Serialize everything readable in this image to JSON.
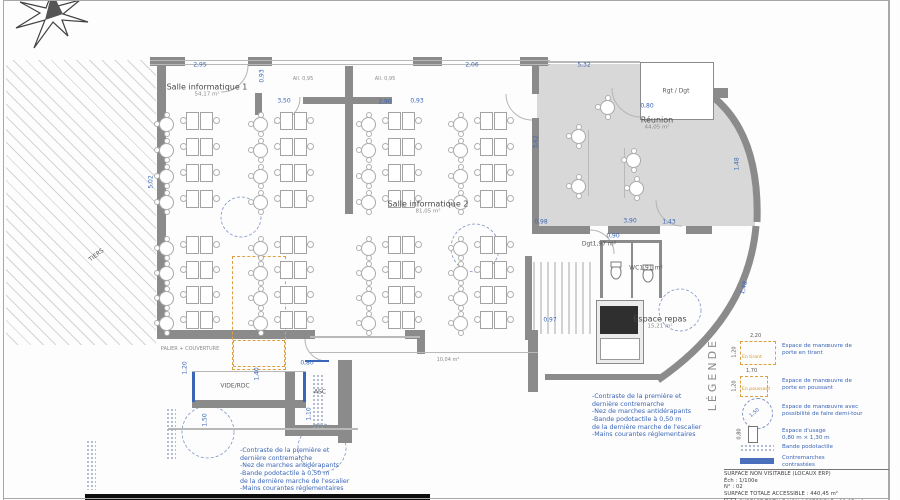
{
  "doc": {
    "kind": "architectural accessibility floor plan"
  },
  "colors": {
    "blue": "#3a66b8",
    "orange": "#dd9f3f",
    "wall": "#8b8b8b",
    "room_fill": "#d8d8d8"
  },
  "rooms": [
    {
      "name": "Salle informatique 1",
      "area": "54,17 m²",
      "x": 207,
      "y": 90,
      "big": true
    },
    {
      "name": "Salle informatique 2",
      "area": "81,05 m²",
      "x": 428,
      "y": 207,
      "big": true
    },
    {
      "name": "Réunion",
      "area": "44,05 m²",
      "x": 657,
      "y": 123,
      "big": true
    },
    {
      "name": "Rgt / Dgt",
      "area": "",
      "x": 676,
      "y": 92,
      "big": false
    },
    {
      "name": "Espace repas",
      "area": "15,21 m²",
      "x": 660,
      "y": 322,
      "big": true
    },
    {
      "name": "Dgt",
      "area": "1,97 m²",
      "x": 599,
      "y": 245,
      "big": false
    },
    {
      "name": "WC",
      "area": "1,91 m²",
      "x": 646,
      "y": 269,
      "big": false
    },
    {
      "name": "ASC",
      "area": "",
      "x": 320,
      "y": 393,
      "big": false
    },
    {
      "name": "VIDE/RDC",
      "area": "",
      "x": 235,
      "y": 387,
      "big": false
    },
    {
      "name": "TIERS",
      "area": "",
      "x": 97,
      "y": 256,
      "big": false,
      "rot": -38
    }
  ],
  "small_labels": [
    {
      "t": "All. 0,95",
      "x": 303,
      "y": 80
    },
    {
      "t": "All. 0,95",
      "x": 385,
      "y": 80
    },
    {
      "t": "10,04 m²",
      "x": 448,
      "y": 361
    },
    {
      "t": "PALIER + COUVERTURE",
      "x": 190,
      "y": 350
    }
  ],
  "dims": [
    {
      "t": "2,95",
      "x": 200,
      "y": 66
    },
    {
      "t": "0,93",
      "x": 263,
      "y": 76,
      "r": 90
    },
    {
      "t": "3,50",
      "x": 284,
      "y": 102
    },
    {
      "t": "2,90",
      "x": 385,
      "y": 103
    },
    {
      "t": "0,93",
      "x": 417,
      "y": 102
    },
    {
      "t": "5,02",
      "x": 152,
      "y": 182,
      "r": 90
    },
    {
      "t": "5,32",
      "x": 584,
      "y": 66
    },
    {
      "t": "0,80",
      "x": 647,
      "y": 107
    },
    {
      "t": "3,62",
      "x": 537,
      "y": 142,
      "r": 90
    },
    {
      "t": "1,48",
      "x": 738,
      "y": 164,
      "r": 90
    },
    {
      "t": "0,98",
      "x": 541,
      "y": 223
    },
    {
      "t": "3,90",
      "x": 630,
      "y": 222
    },
    {
      "t": "1,43",
      "x": 669,
      "y": 223
    },
    {
      "t": "0,80",
      "x": 307,
      "y": 364
    },
    {
      "t": "1,10",
      "x": 310,
      "y": 414,
      "r": 90
    },
    {
      "t": "1,50",
      "x": 206,
      "y": 420,
      "r": 90
    },
    {
      "t": "0,97",
      "x": 550,
      "y": 321
    },
    {
      "t": "1,40",
      "x": 258,
      "y": 374,
      "r": 90
    },
    {
      "t": "1,20",
      "x": 186,
      "y": 368,
      "r": 90
    },
    {
      "t": "0,90",
      "x": 613,
      "y": 237
    },
    {
      "t": "1,48",
      "x": 745,
      "y": 288,
      "r": 75
    },
    {
      "t": "2,06",
      "x": 472,
      "y": 66
    }
  ],
  "notes": {
    "lines": [
      "-Contraste de la première et",
      "dernière contremarche",
      "-Nez de marches antidérapants",
      "-Bande podotactile à 0,50 m",
      "de la dernière marche de l'escalier",
      "-Mains courantes réglementaires"
    ],
    "positions": [
      {
        "x": 240,
        "y": 447
      },
      {
        "x": 592,
        "y": 393
      }
    ]
  },
  "legend": {
    "title": "LÉGENDE",
    "items": [
      {
        "swatch": "rect-orange",
        "w": 34,
        "h": 22,
        "dim_top": "2,20",
        "dim_left": "1,20",
        "tag": "En tirant",
        "desc": [
          "Espace de manœuvre de",
          "porte en tirant"
        ],
        "y": 333
      },
      {
        "swatch": "rect-orange",
        "w": 26,
        "h": 19,
        "dim_top": "1,70",
        "dim_left": "1,20",
        "tag": "En poussant",
        "desc": [
          "Espace de manœuvre de",
          "porte en poussant"
        ],
        "y": 368
      },
      {
        "swatch": "circle-blue",
        "d": 29,
        "dim_diag": "1,50",
        "desc": [
          "Espace de manœuvre avec",
          "possibilité de faire demi-tour"
        ],
        "y": 396
      },
      {
        "swatch": "usage",
        "dim_left": "0,80",
        "desc": [
          "Espace d'usage",
          "0,80 m × 1,30 m"
        ],
        "y": 426
      },
      {
        "swatch": "dots",
        "desc": [
          "Bande podotactile"
        ],
        "y": 443
      },
      {
        "swatch": "bar-blue",
        "desc": [
          "Contremarches",
          "contrastées"
        ],
        "y": 455
      }
    ]
  },
  "title_block": {
    "rows": [
      "SURFACE NON VISITABLE (LOCAUX ERP)",
      "Éch : 1/100e",
      "N° : 02",
      "SURFACE TOTALE ACCESSIBLE : 440,45 m²"
    ],
    "hatch_row": "SURFACE TOTALE NON ACCESSIBLE : 98,05 m²"
  },
  "geometry": {
    "walls": [
      [
        150,
        57,
        35,
        9
      ],
      [
        248,
        57,
        24,
        9
      ],
      [
        413,
        57,
        29,
        9
      ],
      [
        520,
        57,
        28,
        9
      ],
      [
        157,
        62,
        9,
        276
      ],
      [
        157,
        330,
        158,
        9
      ],
      [
        405,
        330,
        20,
        9
      ],
      [
        417,
        330,
        8,
        24
      ],
      [
        345,
        66,
        8,
        148
      ],
      [
        303,
        97,
        89,
        7
      ],
      [
        255,
        93,
        7,
        22
      ],
      [
        532,
        62,
        7,
        32
      ],
      [
        532,
        118,
        7,
        110
      ],
      [
        532,
        226,
        58,
        8
      ],
      [
        608,
        226,
        52,
        8
      ],
      [
        686,
        226,
        26,
        8
      ],
      [
        712,
        88,
        16,
        10
      ],
      [
        600,
        240,
        62,
        3
      ],
      [
        600,
        240,
        3,
        58
      ],
      [
        659,
        240,
        3,
        58
      ],
      [
        631,
        242,
        2,
        56
      ],
      [
        525,
        256,
        7,
        84
      ],
      [
        528,
        330,
        10,
        62
      ],
      [
        545,
        374,
        116,
        6
      ],
      [
        285,
        372,
        10,
        64
      ],
      [
        338,
        360,
        14,
        83
      ],
      [
        285,
        425,
        67,
        11
      ],
      [
        192,
        400,
        114,
        8
      ]
    ],
    "thin_lines": [
      [
        150,
        60,
        400,
        1
      ],
      [
        150,
        64,
        400,
        1
      ],
      [
        548,
        61,
        92,
        2
      ],
      [
        310,
        336,
        110,
        2
      ],
      [
        310,
        352,
        228,
        1
      ],
      [
        192,
        371,
        114,
        1
      ],
      [
        168,
        428,
        190,
        2
      ],
      [
        588,
        130,
        1,
        66
      ],
      [
        624,
        148,
        1,
        50
      ],
      [
        596,
        300,
        46,
        1
      ],
      [
        596,
        300,
        1,
        62
      ],
      [
        641,
        300,
        1,
        62
      ],
      [
        596,
        361,
        46,
        1
      ]
    ],
    "blue_rails": [
      [
        192,
        372,
        3,
        30
      ],
      [
        303,
        372,
        3,
        30
      ],
      [
        305,
        360,
        24,
        2
      ]
    ],
    "orange_rects": [
      [
        232,
        256,
        52,
        112
      ],
      [
        233,
        340,
        50,
        25
      ]
    ],
    "turning_circles": [
      [
        241,
        217,
        20
      ],
      [
        475,
        248,
        24
      ],
      [
        680,
        310,
        21
      ],
      [
        208,
        432,
        26
      ],
      [
        322,
        448,
        24
      ]
    ],
    "dot_strips": [
      [
        312,
        374,
        12,
        54
      ],
      [
        166,
        408,
        10,
        52
      ],
      [
        86,
        440,
        10,
        50
      ]
    ],
    "hatch_areas": [
      [
        6,
        60,
        150,
        285
      ]
    ],
    "dark_bars": [
      [
        85,
        494,
        345,
        6
      ]
    ],
    "frame": [
      [
        3,
        0,
        1,
        500
      ],
      [
        888,
        0,
        2,
        500
      ],
      [
        3,
        498,
        887,
        1
      ],
      [
        3,
        0,
        887,
        1
      ]
    ],
    "appliances": {
      "counter": [
        596,
        300,
        46,
        62
      ],
      "range": [
        600,
        306,
        38,
        28
      ],
      "sink": [
        600,
        338,
        38,
        20
      ]
    }
  },
  "furniture": {
    "desk_cols": [
      {
        "x": 186,
        "y": 112,
        "rows": 4,
        "step": 26
      },
      {
        "x": 280,
        "y": 112,
        "rows": 4,
        "step": 26
      },
      {
        "x": 388,
        "y": 112,
        "rows": 4,
        "step": 26
      },
      {
        "x": 480,
        "y": 112,
        "rows": 4,
        "step": 26
      },
      {
        "x": 186,
        "y": 236,
        "rows": 4,
        "step": 25
      },
      {
        "x": 280,
        "y": 236,
        "rows": 4,
        "step": 25
      },
      {
        "x": 388,
        "y": 236,
        "rows": 4,
        "step": 25
      },
      {
        "x": 480,
        "y": 236,
        "rows": 4,
        "step": 25
      }
    ],
    "table_cols": [
      {
        "x": 158,
        "y": 116,
        "rows": 4,
        "step": 26
      },
      {
        "x": 252,
        "y": 116,
        "rows": 4,
        "step": 26
      },
      {
        "x": 360,
        "y": 116,
        "rows": 4,
        "step": 26
      },
      {
        "x": 452,
        "y": 116,
        "rows": 4,
        "step": 26
      },
      {
        "x": 158,
        "y": 240,
        "rows": 4,
        "step": 25
      },
      {
        "x": 252,
        "y": 240,
        "rows": 4,
        "step": 25
      },
      {
        "x": 360,
        "y": 240,
        "rows": 4,
        "step": 25
      },
      {
        "x": 452,
        "y": 240,
        "rows": 4,
        "step": 25
      }
    ],
    "single_tables": [
      [
        607,
        107
      ],
      [
        578,
        136
      ],
      [
        578,
        186
      ],
      [
        633,
        160
      ],
      [
        636,
        188
      ]
    ]
  }
}
